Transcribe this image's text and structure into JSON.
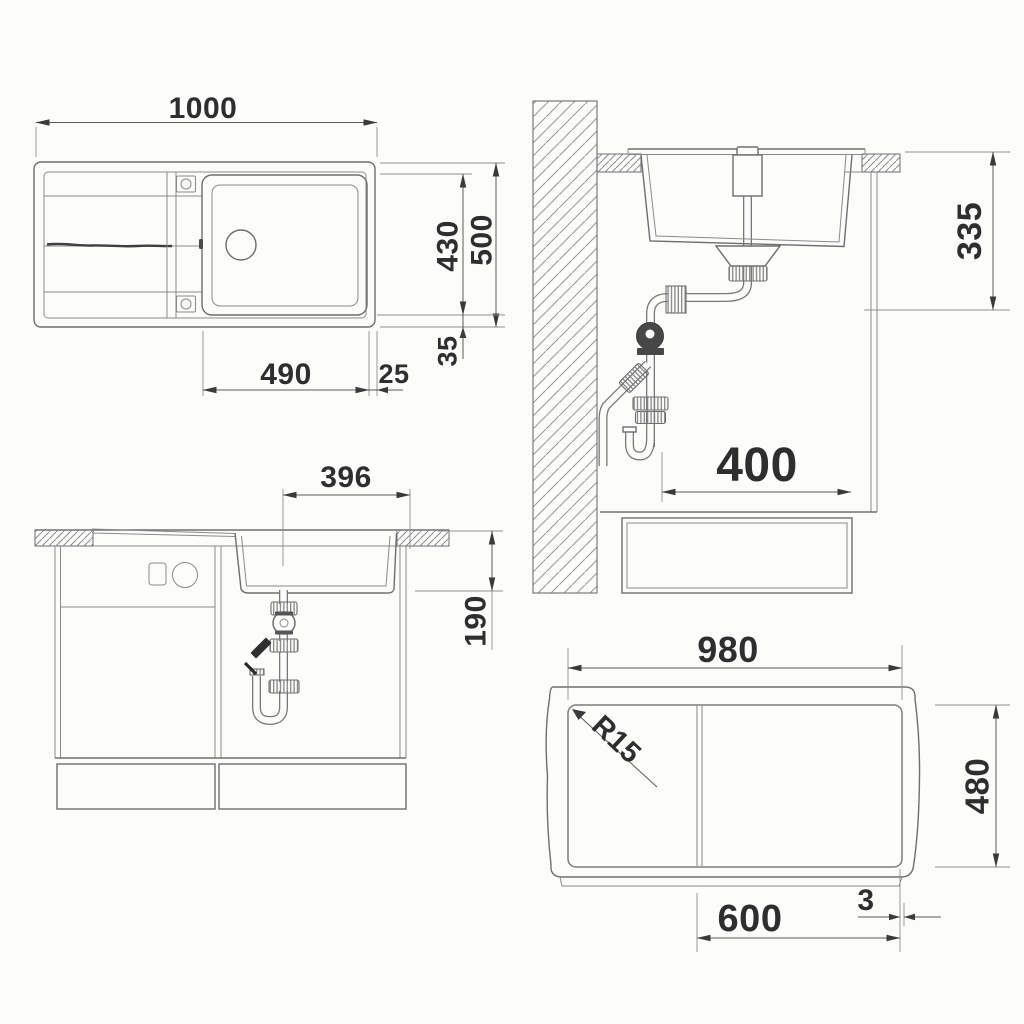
{
  "drawing": {
    "title": "sink-installation-dimension-drawing",
    "plan": {
      "width": "1000",
      "bowl_depth": "430",
      "depth": "500",
      "bowl_width": "490",
      "edge_gap": "25",
      "rim_offset": "35"
    },
    "section": {
      "under_counter_depth": "335",
      "clearance": "400"
    },
    "front": {
      "bowl_top_width": "396",
      "bowl_height": "190"
    },
    "cutout": {
      "width": "980",
      "height": "480",
      "base_width": "600",
      "edge_gap": "3",
      "corner_radius": "R15"
    },
    "colors": {
      "line": "#6e6e6e",
      "dimension": "#3a3a3a",
      "text": "#2e2e2e",
      "background": "#fcfcfb"
    }
  }
}
